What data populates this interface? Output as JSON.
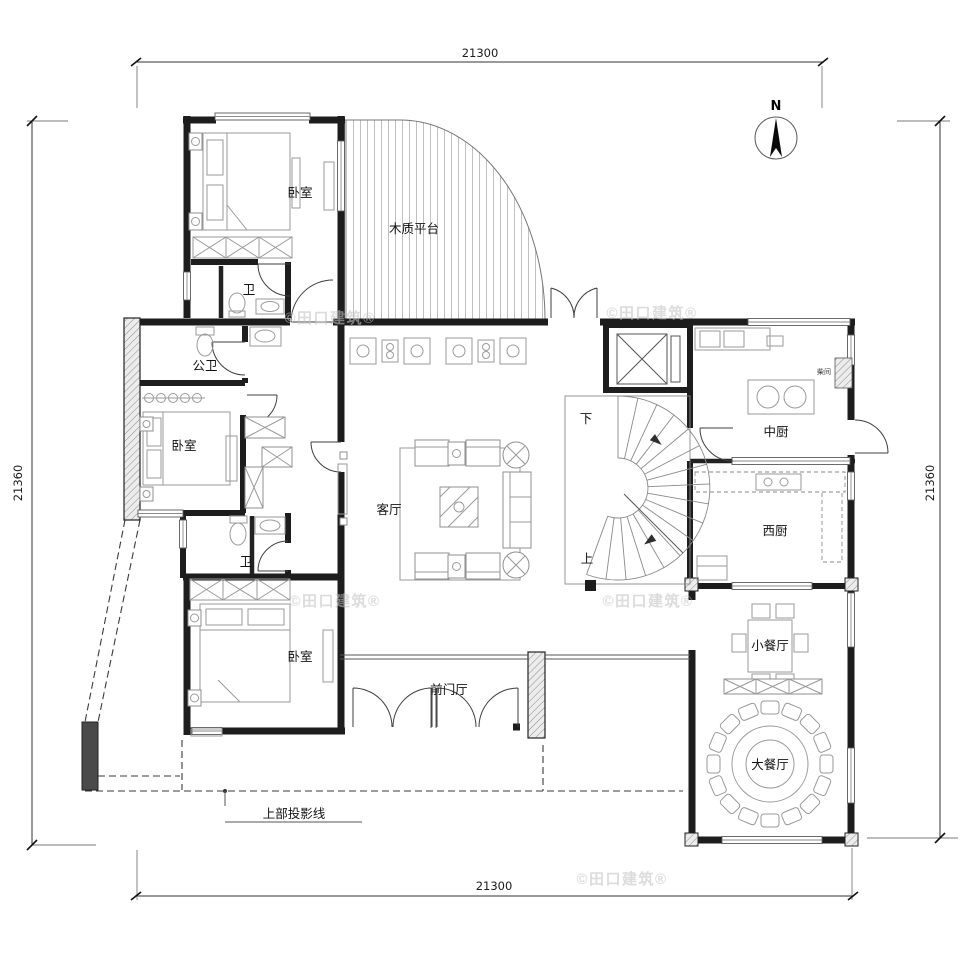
{
  "dims": {
    "top": "21300",
    "bottom": "21300",
    "left": "21360",
    "right": "21360"
  },
  "compass": {
    "label": "N"
  },
  "rooms": {
    "bedroom_top": "卧室",
    "bath_top": "卫",
    "wood_platform": "木质平台",
    "public_bath": "公卫",
    "bedroom_mid": "卧室",
    "bath_mid": "卫",
    "living": "客厅",
    "bedroom_bottom": "卧室",
    "entry_hall": "前门厅",
    "chinese_kitchen": "中厨",
    "storage": "柴间",
    "western_kitchen": "西厨",
    "small_dining": "小餐厅",
    "large_dining": "大餐厅"
  },
  "stairs": {
    "down": "下",
    "up": "上"
  },
  "notes": {
    "projection": "上部投影线"
  },
  "watermark": {
    "text": "©田口建筑®"
  },
  "colors": {
    "wall": "#1d1d1d",
    "furniture": "#9a9a9a",
    "watermark": "#c3c3c3",
    "pier_fill": "#4a4a4a"
  }
}
